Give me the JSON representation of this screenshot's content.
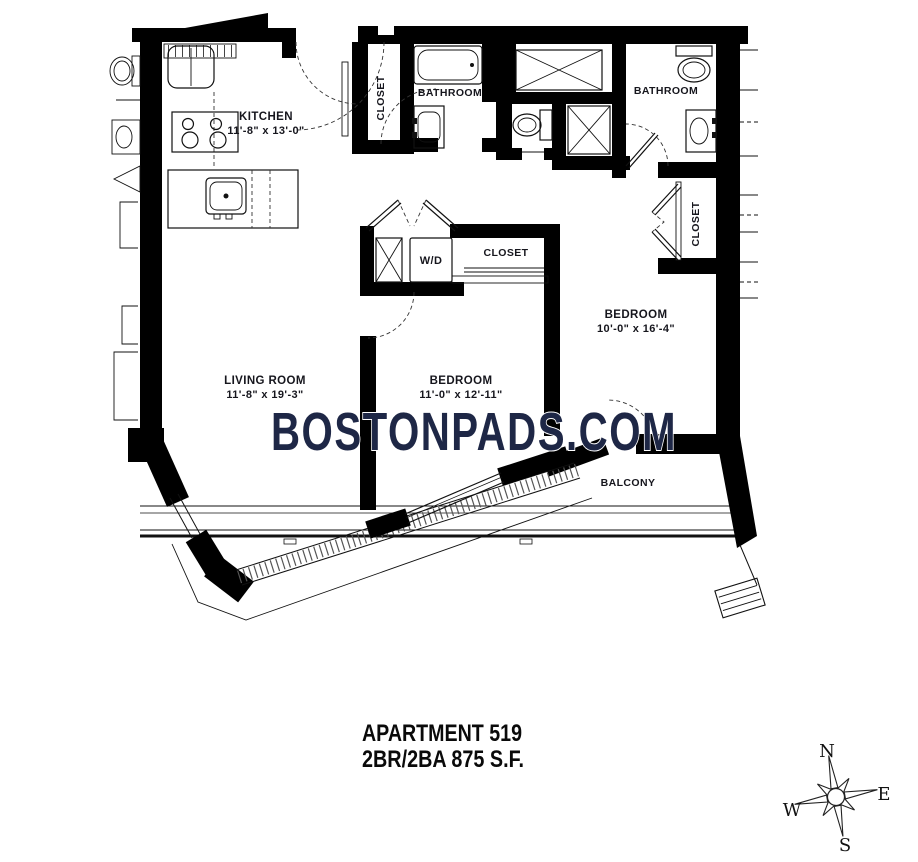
{
  "plan": {
    "watermark": "BOSTONPADS.COM",
    "apartment": {
      "line1": "APARTMENT 519",
      "line2": "2BR/2BA 875 S.F."
    },
    "rooms": {
      "kitchen": {
        "label": "KITCHEN",
        "dims": "11'-8\" x 13'-0\""
      },
      "living_room": {
        "label": "LIVING ROOM",
        "dims": "11'-8\" x 19'-3\""
      },
      "bedroom_1": {
        "label": "BEDROOM",
        "dims": "11'-0\" x 12'-11\""
      },
      "bedroom_2": {
        "label": "BEDROOM",
        "dims": "10'-0\" x 16'-4\""
      },
      "bathroom_1": {
        "label": "BATHROOM"
      },
      "bathroom_2": {
        "label": "BATHROOM"
      },
      "entry_closet": {
        "label": "CLOSET"
      },
      "hall_closet": {
        "label": "CLOSET"
      },
      "bedroom_2_closet": {
        "label": "CLOSET"
      },
      "laundry": {
        "label": "W/D"
      },
      "balcony": {
        "label": "BALCONY"
      }
    },
    "compass": {
      "n": "N",
      "e": "E",
      "s": "S",
      "w": "W"
    },
    "colors": {
      "wall": "#000000",
      "watermark": "#1e2746",
      "label": "#16161d",
      "background": "#ffffff"
    }
  }
}
